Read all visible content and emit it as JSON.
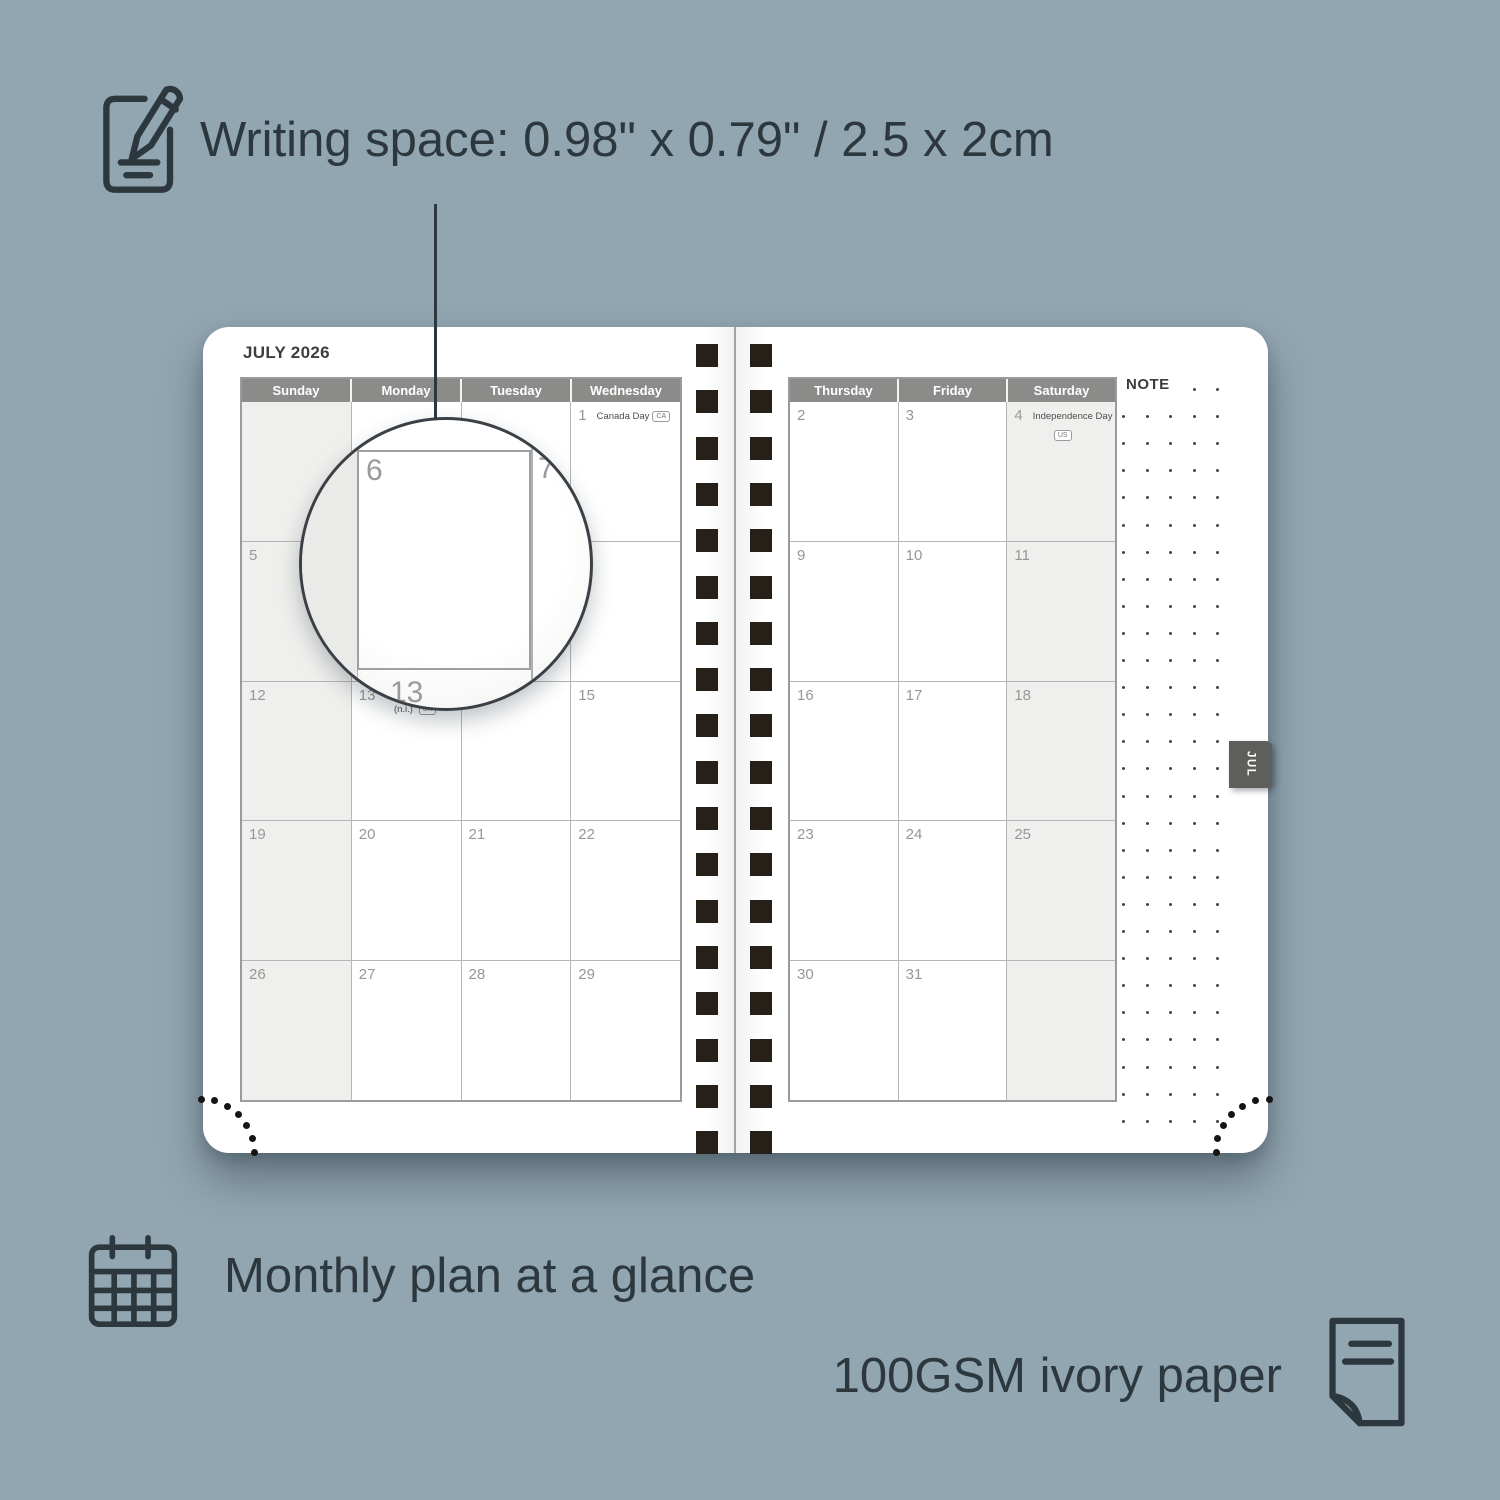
{
  "colors": {
    "background": "#92a6b2",
    "ink": "#2d383e",
    "header_gray": "#8b8b89",
    "weekend_shade": "#efefed",
    "grid_line": "#b5b5b5",
    "grid_border": "#9b9b9b",
    "day_number": "#979797",
    "holiday_text": "#4c4c4c",
    "spiral_square": "#262019",
    "tab_bg": "#5e5e5b",
    "page_bg": "#ffffff"
  },
  "annotations": {
    "writing_space": "Writing space: 0.98\" x 0.79\" / 2.5 x 2cm",
    "monthly_plan": "Monthly plan at a glance",
    "paper_spec": "100GSM ivory paper"
  },
  "planner": {
    "month_title": "JULY 2026",
    "note_label": "NOTE",
    "month_tab": "JUL",
    "magnifier": {
      "cell_day": "6",
      "next_day": "7",
      "bottom_day": "13"
    },
    "left_page": {
      "day_headers": [
        "Sunday",
        "Monday",
        "Tuesday",
        "Wednesday"
      ],
      "weekend_col": 0,
      "rows": [
        [
          {
            "day": ""
          },
          {
            "day": ""
          },
          {
            "day": ""
          },
          {
            "day": "1",
            "holiday": "Canada Day",
            "badge": "CA",
            "badge_placement": "inline"
          }
        ],
        [
          {
            "day": "5"
          },
          {
            "day": "6"
          },
          {
            "day": "7"
          },
          {
            "day": "8"
          }
        ],
        [
          {
            "day": "12"
          },
          {
            "day": "13",
            "holiday": "Orangemen's Day",
            "holiday_line2": "(n.i.)",
            "badge": "UK",
            "badge_placement": "line2"
          },
          {
            "day": "14"
          },
          {
            "day": "15"
          }
        ],
        [
          {
            "day": "19"
          },
          {
            "day": "20"
          },
          {
            "day": "21"
          },
          {
            "day": "22"
          }
        ],
        [
          {
            "day": "26"
          },
          {
            "day": "27"
          },
          {
            "day": "28"
          },
          {
            "day": "29"
          }
        ]
      ]
    },
    "right_page": {
      "day_headers": [
        "Thursday",
        "Friday",
        "Saturday"
      ],
      "weekend_col": 2,
      "rows": [
        [
          {
            "day": "2"
          },
          {
            "day": "3"
          },
          {
            "day": "4",
            "holiday": "Independence Day",
            "badge": "US",
            "badge_placement": "below"
          }
        ],
        [
          {
            "day": "9"
          },
          {
            "day": "10"
          },
          {
            "day": "11"
          }
        ],
        [
          {
            "day": "16"
          },
          {
            "day": "17"
          },
          {
            "day": "18"
          }
        ],
        [
          {
            "day": "23"
          },
          {
            "day": "24"
          },
          {
            "day": "25"
          }
        ],
        [
          {
            "day": "30"
          },
          {
            "day": "31"
          },
          {
            "day": ""
          }
        ]
      ]
    }
  }
}
